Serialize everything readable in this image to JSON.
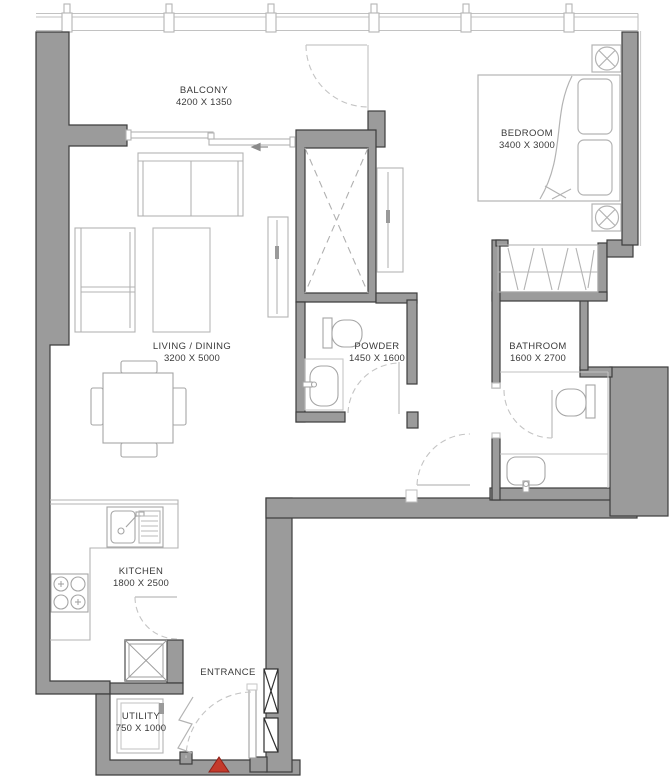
{
  "plan": {
    "type": "apartment-floor-plan",
    "rooms": [
      {
        "id": "balcony",
        "name": "BALCONY",
        "dims": "4200 X 1350"
      },
      {
        "id": "bedroom",
        "name": "BEDROOM",
        "dims": "3400 X 3000"
      },
      {
        "id": "living",
        "name": "LIVING / DINING",
        "dims": "3200 X 5000"
      },
      {
        "id": "powder",
        "name": "POWDER",
        "dims": "1450 X 1600"
      },
      {
        "id": "bathroom",
        "name": "BATHROOM",
        "dims": "1600 X 2700"
      },
      {
        "id": "kitchen",
        "name": "KITCHEN",
        "dims": "1800 X 2500"
      },
      {
        "id": "entrance",
        "name": "ENTRANCE",
        "dims": ""
      },
      {
        "id": "utility",
        "name": "UTILITY",
        "dims": "750 X 1000"
      }
    ],
    "colors": {
      "wall_fill": "#9b9b9b",
      "wall_outline": "#3d3d3d",
      "furniture_line": "#b3b3b3",
      "fixture_line": "#a5a5a5",
      "door_arc": "#c4c4c4",
      "text": "#3a3a3a",
      "entrance_marker": "#c43a2b"
    }
  }
}
